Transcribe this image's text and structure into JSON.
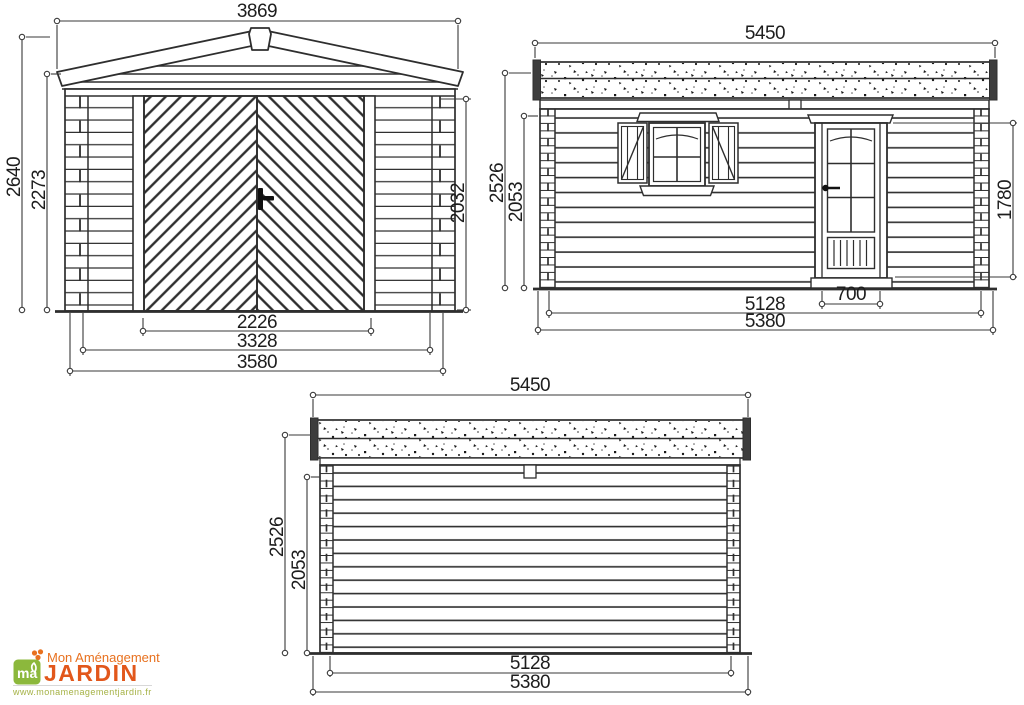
{
  "palette": {
    "line_color": "#2e2e2e",
    "dimension_color": "#3a3a3a",
    "logo_orange": "#e8711f",
    "logo_orange_dark": "#e2571b",
    "logo_green": "#8cb83c",
    "logo_url_green": "#a5b245",
    "background": "#ffffff"
  },
  "views": {
    "front": {
      "title": "front-elevation-with-garage-door",
      "dims": {
        "roof_width": "3869",
        "total_height": "2640",
        "eave_height": "2273",
        "door_height": "2032",
        "door_opening_width": "2226",
        "inner_width": "3328",
        "base_width": "3580"
      }
    },
    "side": {
      "title": "side-elevation-with-door-and-window",
      "dims": {
        "roof_width": "5450",
        "total_height": "2526",
        "wall_height": "2053",
        "door_height": "1780",
        "door_width": "700",
        "inner_width": "5128",
        "base_width": "5380"
      }
    },
    "rear": {
      "title": "rear-elevation",
      "dims": {
        "roof_width": "5450",
        "total_height": "2526",
        "wall_height": "2053",
        "inner_width": "5128",
        "base_width": "5380"
      }
    }
  },
  "logo": {
    "tagline": "Mon Aménagement",
    "brand": "JARDIN",
    "monogram": "ma",
    "website": "www.monamenagementjardin.fr"
  }
}
